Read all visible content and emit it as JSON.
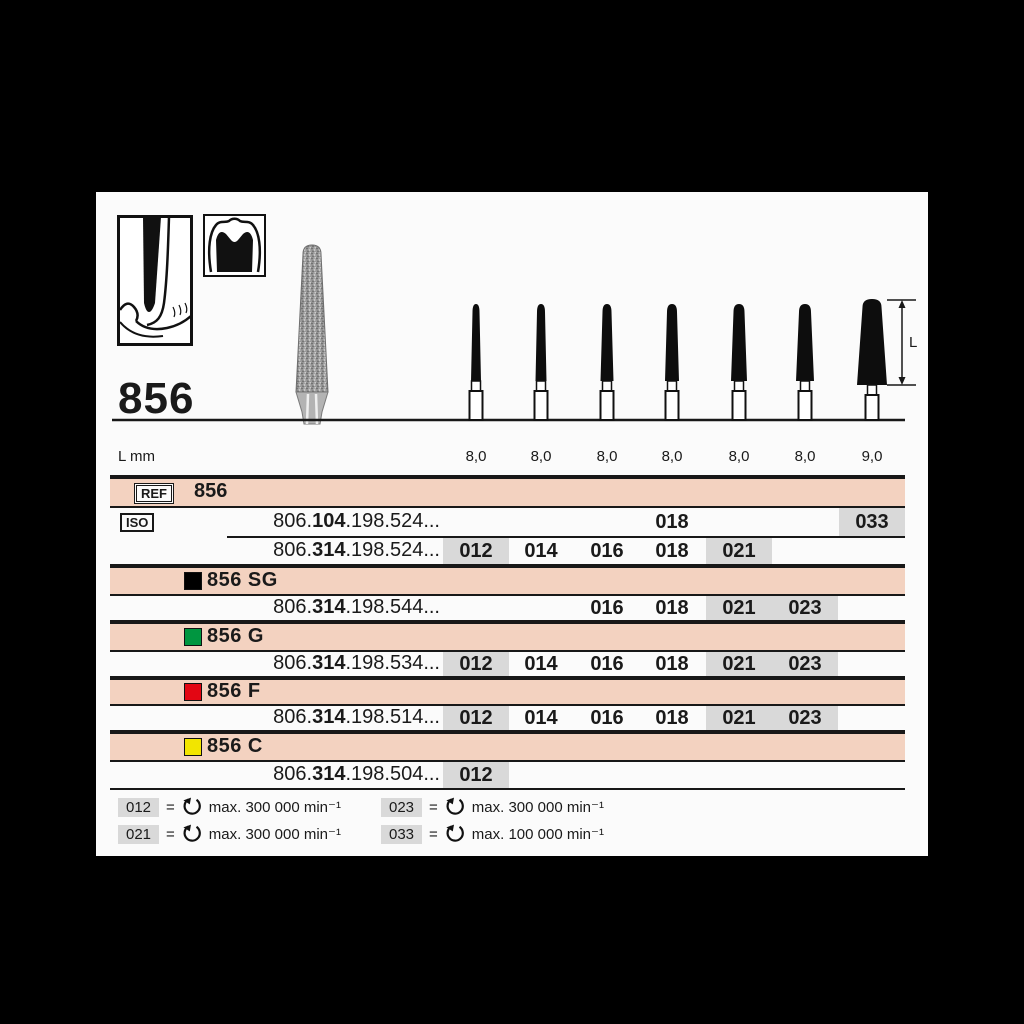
{
  "panel": {
    "headline": "856",
    "dim_label": "L"
  },
  "size_row": {
    "label": "L mm",
    "values": [
      "8,0",
      "8,0",
      "8,0",
      "8,0",
      "8,0",
      "8,0",
      "9,0"
    ]
  },
  "table": {
    "ref_tag": "REF",
    "ref_value": "856",
    "iso_tag": "ISO",
    "row104": {
      "pre": "806.",
      "bold": "104",
      "post": ".198.524...",
      "c4": "018",
      "c7": "033"
    },
    "row524": {
      "pre": "806.",
      "bold": "314",
      "post": ".198.524...",
      "c1": "012",
      "c2": "014",
      "c3": "016",
      "c4": "018",
      "c5": "021"
    },
    "variant_sg": "856 SG",
    "row544": {
      "pre": "806.",
      "bold": "314",
      "post": ".198.544...",
      "c3": "016",
      "c4": "018",
      "c5": "021",
      "c6": "023"
    },
    "variant_g": "856 G",
    "row534": {
      "pre": "806.",
      "bold": "314",
      "post": ".198.534...",
      "c1": "012",
      "c2": "014",
      "c3": "016",
      "c4": "018",
      "c5": "021",
      "c6": "023"
    },
    "variant_f": "856 F",
    "row514": {
      "pre": "806.",
      "bold": "314",
      "post": ".198.514...",
      "c1": "012",
      "c2": "014",
      "c3": "016",
      "c4": "018",
      "c5": "021",
      "c6": "023"
    },
    "variant_c": "856 C",
    "row504": {
      "pre": "806.",
      "bold": "314",
      "post": ".198.504...",
      "c1": "012"
    }
  },
  "legend": {
    "eq": "=",
    "items": [
      {
        "size": "012",
        "text": "max. 300 000 min⁻¹"
      },
      {
        "size": "021",
        "text": "max. 300 000 min⁻¹"
      },
      {
        "size": "023",
        "text": "max. 300 000 min⁻¹"
      },
      {
        "size": "033",
        "text": "max. 100 000 min⁻¹"
      }
    ]
  },
  "colors": {
    "pink": "#f3d2c0",
    "gray": "#d9d9d9",
    "sq_sg": "#000000",
    "sq_g": "#009640",
    "sq_f": "#e30613",
    "sq_c": "#f2e500"
  }
}
